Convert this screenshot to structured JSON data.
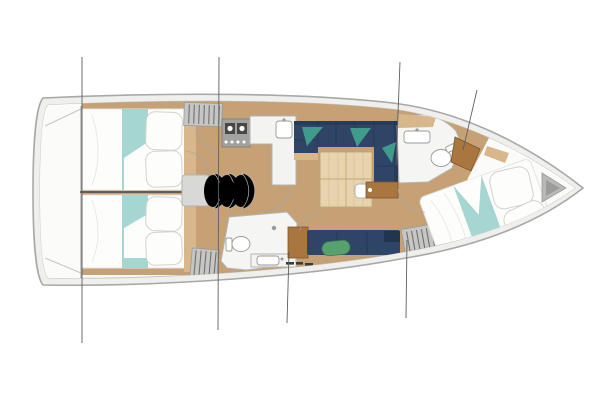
{
  "title": "sailboat-interior-deck-plan",
  "vessel": {
    "type": "monohull-sailing-yacht-layout-top-view",
    "orientation": "bow-right-stern-left",
    "areas": [
      "stern-platform",
      "aft-cabin-port",
      "aft-cabin-starboard",
      "companionway-steps",
      "nav-desk",
      "galley-stove",
      "galley-counter",
      "salon-sofa-u-shape",
      "salon-table",
      "salon-chairs",
      "aft-head-toilet-sink",
      "starboard-bench",
      "storage-lockers",
      "forward-head-toilet-sink",
      "v-berth-cabin",
      "anchor-locker",
      "rigging-lines"
    ],
    "berth_count": 3,
    "head_count": 2
  },
  "colors": {
    "background": "#ffffff",
    "hull_outline": "#a8a8a6",
    "deck_band": "#efefed",
    "deck_inner_line": "#c6c6c4",
    "interior_white": "#fbfbfa",
    "floor_wood": "#c7a176",
    "side_trim_wood": "#d9b78c",
    "bed_white": "#fdfdfc",
    "bed_shadow": "#e4e4e2",
    "pillow_line": "#d2d2d0",
    "aqua": "#a6d6d2",
    "navy": "#2f4568",
    "navy_dark": "#22344e",
    "teal_cushion": "#3f9c8b",
    "green_cushion": "#57a06f",
    "green_cushion_edge": "#3f7f53",
    "table_wood": "#e7d3ae",
    "table_grain": "#d9c098",
    "table_line": "#c2a878",
    "cabinet_wood": "#a9763f",
    "cabinet_wood_dark": "#7e5528",
    "counter_white": "#f3f3f1",
    "counter_line": "#b4b4b2",
    "bath_white": "#f5f5f3",
    "appliance_gray": "#a2a2a0",
    "appliance_edge": "#7c7c7a",
    "appliance_dark": "#474745",
    "louver_gray": "#c6c6c4",
    "louver_line": "#70706e",
    "fixture_line": "#9a9a98",
    "desk_gray": "#d8d8d6",
    "locker_gray": "#b9b9b7",
    "locker_dark": "#9c9c9a",
    "item_dark": "#3a3a38",
    "divider_dark": "#55554f",
    "rigging": "#5f5f5d",
    "arc_line": "#a5a5a3"
  }
}
